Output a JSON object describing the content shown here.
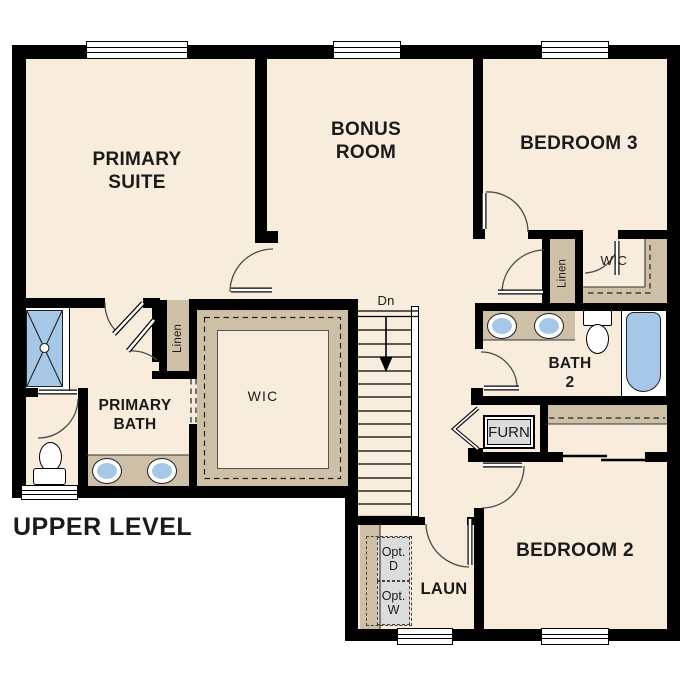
{
  "plan_title": "UPPER LEVEL",
  "rooms": {
    "primary_suite": "PRIMARY SUITE",
    "bonus_room": "BONUS ROOM",
    "bedroom3": "BEDROOM 3",
    "bedroom2": "BEDROOM 2",
    "primary_bath": "PRIMARY BATH",
    "bath2": "BATH 2",
    "wic_primary": "WIC",
    "wic_bedroom3": "WIC",
    "linen_primary": "Linen",
    "linen_bedroom3": "Linen",
    "laundry": "LAUN",
    "furnace": "FURN",
    "stair_direction": "Dn",
    "opt_dryer": "Opt. D",
    "opt_washer": "Opt. W"
  },
  "colors": {
    "wall": "#000000",
    "floor": "#f8ecdc",
    "casework_tan": "#cdc0a7",
    "fixture_blue": "#a7c7e7",
    "equipment_gray": "#dcdcdc"
  },
  "icons": {
    "shower": "shower-pan-icon",
    "tub": "bathtub-icon",
    "toilet": "toilet-icon",
    "sink": "sink-icon",
    "stairs": "stairs-down-icon"
  }
}
